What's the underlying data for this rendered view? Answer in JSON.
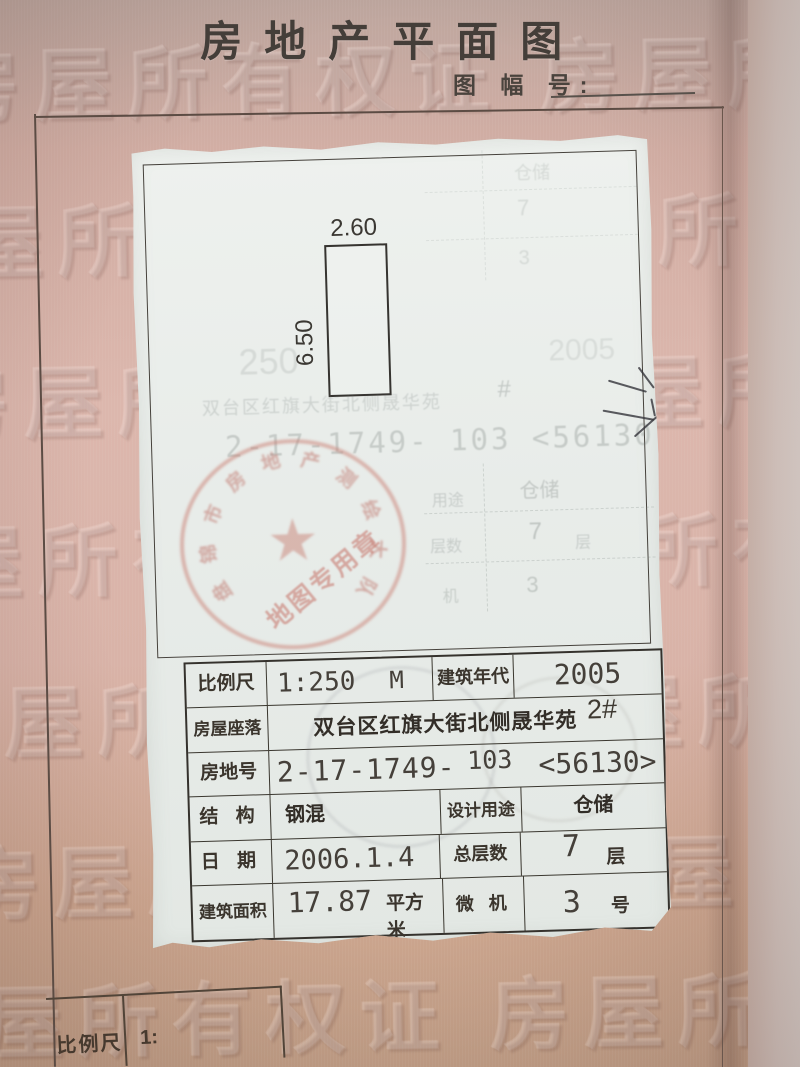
{
  "page": {
    "title": "房地产平面图",
    "sheet_label": "图 幅 号:",
    "watermark": "房屋所有权证  房屋所有权证",
    "mini_scale": {
      "label": "比例尺",
      "value": "1:"
    }
  },
  "plan": {
    "width_label": "2.60",
    "height_label": "6.50"
  },
  "stamp": {
    "ring_text": "盘锦市房地产测绘大队",
    "banner_text": "地图专用章",
    "star_icon": "★",
    "color": "#c97f72"
  },
  "ghosts": {
    "scale": "250",
    "year": "2005",
    "address": "双台区红旗大街北侧晟华苑",
    "hash": "#",
    "parcel": "2-17-1749- 103 <56130",
    "top_use": "仓储",
    "top_floors": "7",
    "top_unit": "3",
    "mid_use_label": "用途",
    "mid_use": "仓储",
    "mid_floors_label": "层数",
    "mid_floors": "7",
    "mid_floors_unit": "层",
    "mid_machine_label": "机",
    "mid_machine": "3"
  },
  "table": {
    "r1": {
      "label": "比例尺",
      "value": "1:250",
      "unit": "M",
      "label2": "建筑年代",
      "value2": "2005"
    },
    "r2": {
      "label": "房屋座落",
      "value": "双台区红旗大街北侧晟华苑",
      "note": "2#"
    },
    "r3": {
      "label": "房地号",
      "v1": "2-17-1749-",
      "v2": "103",
      "v3": "<56130>"
    },
    "r4": {
      "label": "结  构",
      "value": "钢混",
      "label2": "设计用途",
      "value2": "仓储"
    },
    "r5": {
      "label": "日  期",
      "value": "2006.1.4",
      "label2": "总层数",
      "value2": "7",
      "unit": "层"
    },
    "r6": {
      "label": "建筑面积",
      "value": "17.87",
      "unit1": "平方米",
      "label2": "微  机",
      "value2": "3",
      "unit2": "号"
    }
  }
}
